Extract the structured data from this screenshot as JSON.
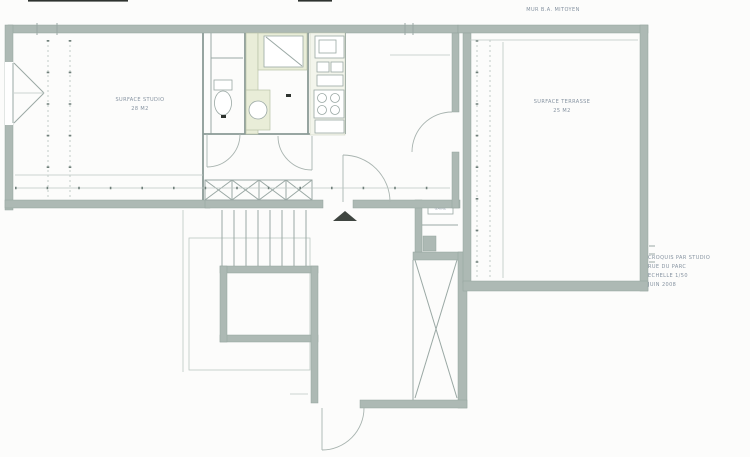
{
  "plan": {
    "party_wall_label": "MUR B.A. MITOYEN",
    "rooms": {
      "studio": {
        "name": "SURFACE STUDIO",
        "area": "28 M2"
      },
      "terrace": {
        "name": "SURFACE TERRASSE",
        "area": "25 M2"
      },
      "duct_label": "GAINE"
    },
    "title_block": {
      "line1": "CROQUIS PAR STUDIO",
      "line2": "RUE DU PARC",
      "line3": "ECHELLE 1/50",
      "line4": "JUIN 2008"
    },
    "colors": {
      "wall": "#adb9b4",
      "fixture_green": "#e9edd8",
      "line": "#9aa8a4",
      "text": "#8592a0"
    }
  }
}
